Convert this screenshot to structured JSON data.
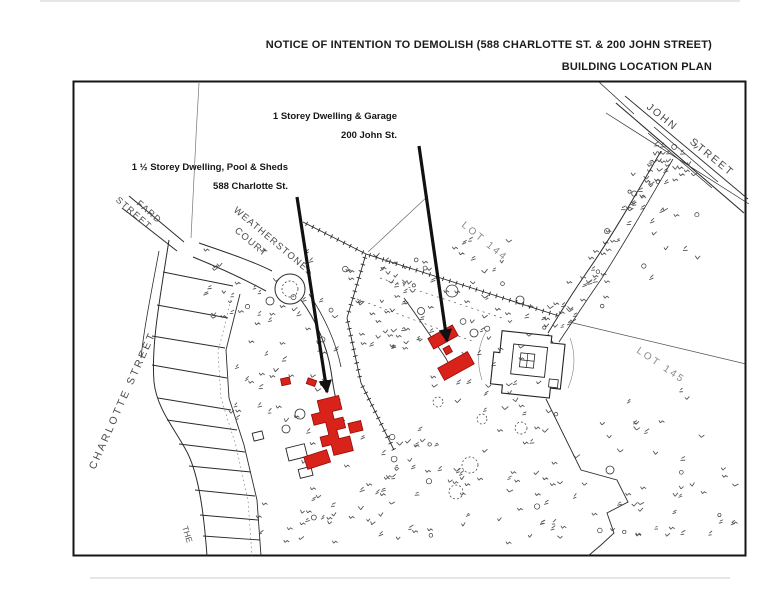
{
  "page_header": {
    "title": "NOTICE OF INTENTION TO DEMOLISH (588 CHARLOTTE ST. & 200 JOHN STREET)",
    "subtitle": "BUILDING LOCATION PLAN"
  },
  "annotations": {
    "john_street_property": {
      "line1": "1 Storey Dwelling & Garage",
      "line2": "200 John St."
    },
    "charlotte_street_property": {
      "line1": "1 ½ Storey Dwelling, Pool & Sheds",
      "line2": "588 Charlotte St."
    }
  },
  "map": {
    "street_labels": {
      "charlotte": "CHARLOTTE STREET",
      "fard_line1": "FARD",
      "fard_line2": "STREET",
      "weatherstone_line1": "WEATHERSTONE",
      "weatherstone_line2": "COURT",
      "john": "JOHN STREET",
      "partial_bottom": "THE"
    },
    "lot_labels": {
      "lot_144": "LOT 144",
      "lot_145": "LOT 145"
    },
    "colors": {
      "demolish_red": "#d9221a",
      "linework": "#2b2b2b",
      "label_gray": "#6e6e6e"
    }
  }
}
